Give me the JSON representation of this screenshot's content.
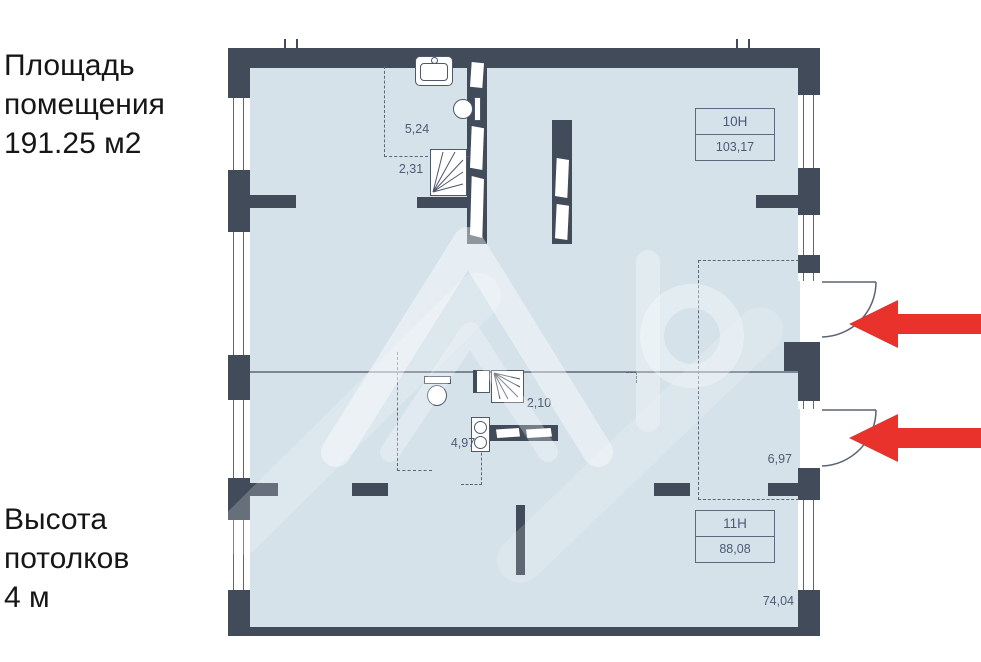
{
  "colors": {
    "arrow_red": "#e8322b",
    "wall": "#414b59",
    "plan_fill": "#d5e2ea"
  },
  "left_panel": {
    "area": [
      "Площадь",
      "помещения",
      "191.25 м2"
    ],
    "ceiling": [
      "Высота",
      "потолков",
      "4 м"
    ]
  },
  "plan": {
    "units": [
      {
        "id": "10Н",
        "area": "103,17"
      },
      {
        "id": "11Н",
        "area": "88,08"
      }
    ],
    "dims": {
      "d524": "5,24",
      "d231": "2,31",
      "d210": "2,10",
      "d497": "4,97",
      "d697": "6,97",
      "d7404": "74,04"
    }
  },
  "watermark": {
    "name": "avito-logo-watermark"
  }
}
